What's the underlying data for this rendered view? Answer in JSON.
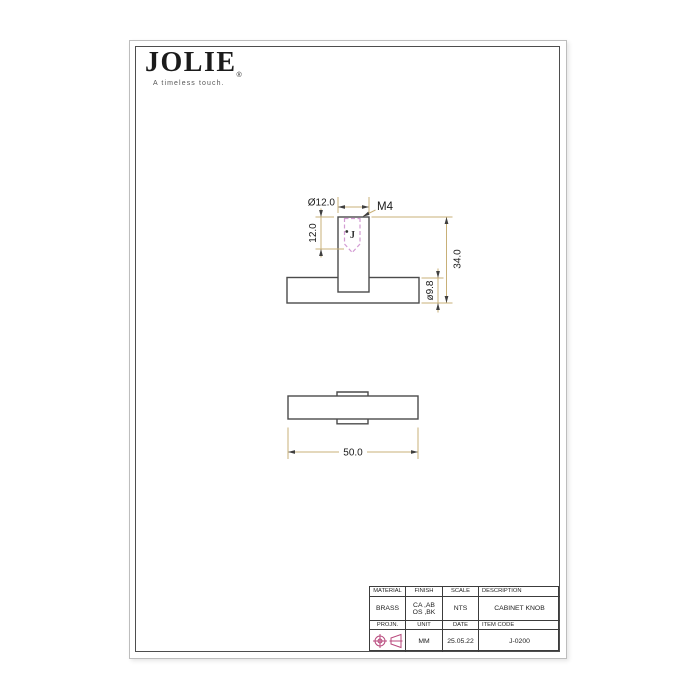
{
  "logo": {
    "name": "JOLIE",
    "reg": "®",
    "tagline": "A timeless touch."
  },
  "drawing": {
    "description": "cabinet knob orthographic views",
    "dimensions": {
      "stem_diameter": "Ø12.0",
      "thread_callout": "M4",
      "thread_depth": "12.0",
      "total_height": "34.0",
      "base_thickness": "ø9.8",
      "base_diameter": "50.0"
    },
    "artifact_mark": "J",
    "colors": {
      "outline": "#4b4b4b",
      "dimension_line": "#c8b078",
      "thread_hidden_line": "#d39bd3",
      "projection_symbol": "#b8487c",
      "text": "#1a1a1a"
    }
  },
  "title_block": {
    "headers": {
      "material": "MATERIAL",
      "finish": "FINISH",
      "scale": "SCALE",
      "description": "DESCRIPTION",
      "projection": "PROJN.",
      "unit": "UNIT",
      "date": "DATE",
      "item_code": "ITEM CODE"
    },
    "values": {
      "material": "BRASS",
      "finish_line1": "CA ,AB",
      "finish_line2": "OS ,BK",
      "scale": "NTS",
      "description": "CABINET KNOB",
      "unit": "MM",
      "date": "25.05.22",
      "item_code": "J-0200"
    }
  }
}
